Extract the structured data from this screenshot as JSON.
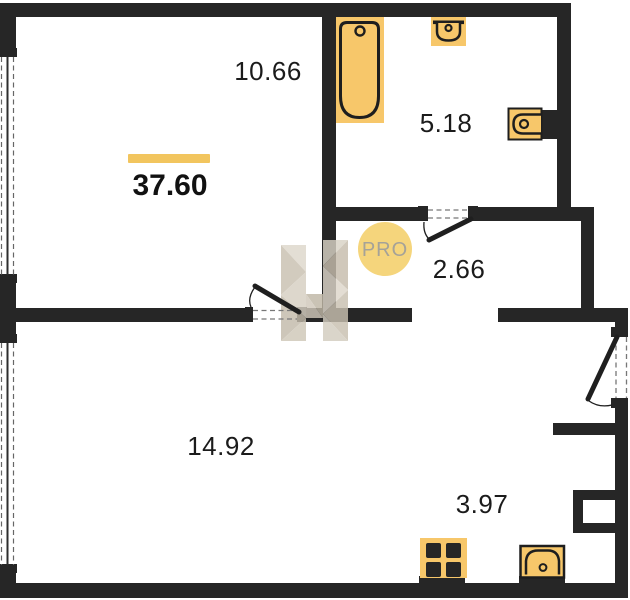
{
  "floorplan": {
    "total_area": "37.60",
    "rooms": [
      {
        "name": "bedroom",
        "area": "10.66"
      },
      {
        "name": "bathroom",
        "area": "5.18"
      },
      {
        "name": "hallway",
        "area": "2.66"
      },
      {
        "name": "living-room",
        "area": "14.92"
      },
      {
        "name": "kitchen-zone",
        "area": "3.97"
      }
    ],
    "watermark": {
      "logo": "h-monogram",
      "badge": "PRO"
    },
    "fixtures": [
      "bathtub",
      "wash-basin",
      "toilet",
      "stove",
      "kitchen-sink"
    ],
    "colors": {
      "walls": "#262626",
      "fixtures": "#f7c76a",
      "accent_bar": "#f2c55e",
      "badge_bg": "#f5d57c",
      "badge_text": "#a5a298",
      "text": "#1b1b1b"
    }
  }
}
